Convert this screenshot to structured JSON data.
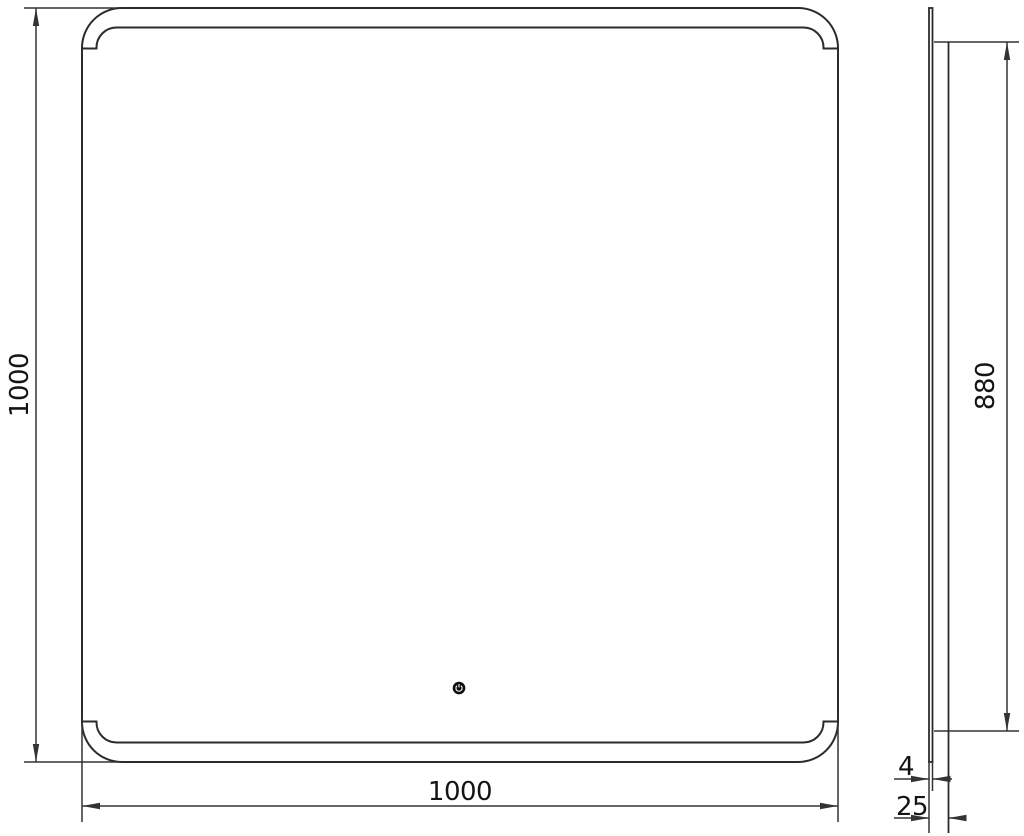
{
  "meta": {
    "background_color": "#ffffff",
    "line_color": "#2b2b2b",
    "dim_line_color": "#333333",
    "text_color": "#141414",
    "button_color": "#0c0c0c",
    "button_glyph_color": "#ffffff",
    "touch_button_icon": "power-touch-icon"
  },
  "front_view": {
    "width_dim": "1000",
    "height_dim": "1000"
  },
  "side_view": {
    "backlight_height_dim": "880",
    "glass_thickness_dim": "4",
    "depth_dim": "25"
  }
}
